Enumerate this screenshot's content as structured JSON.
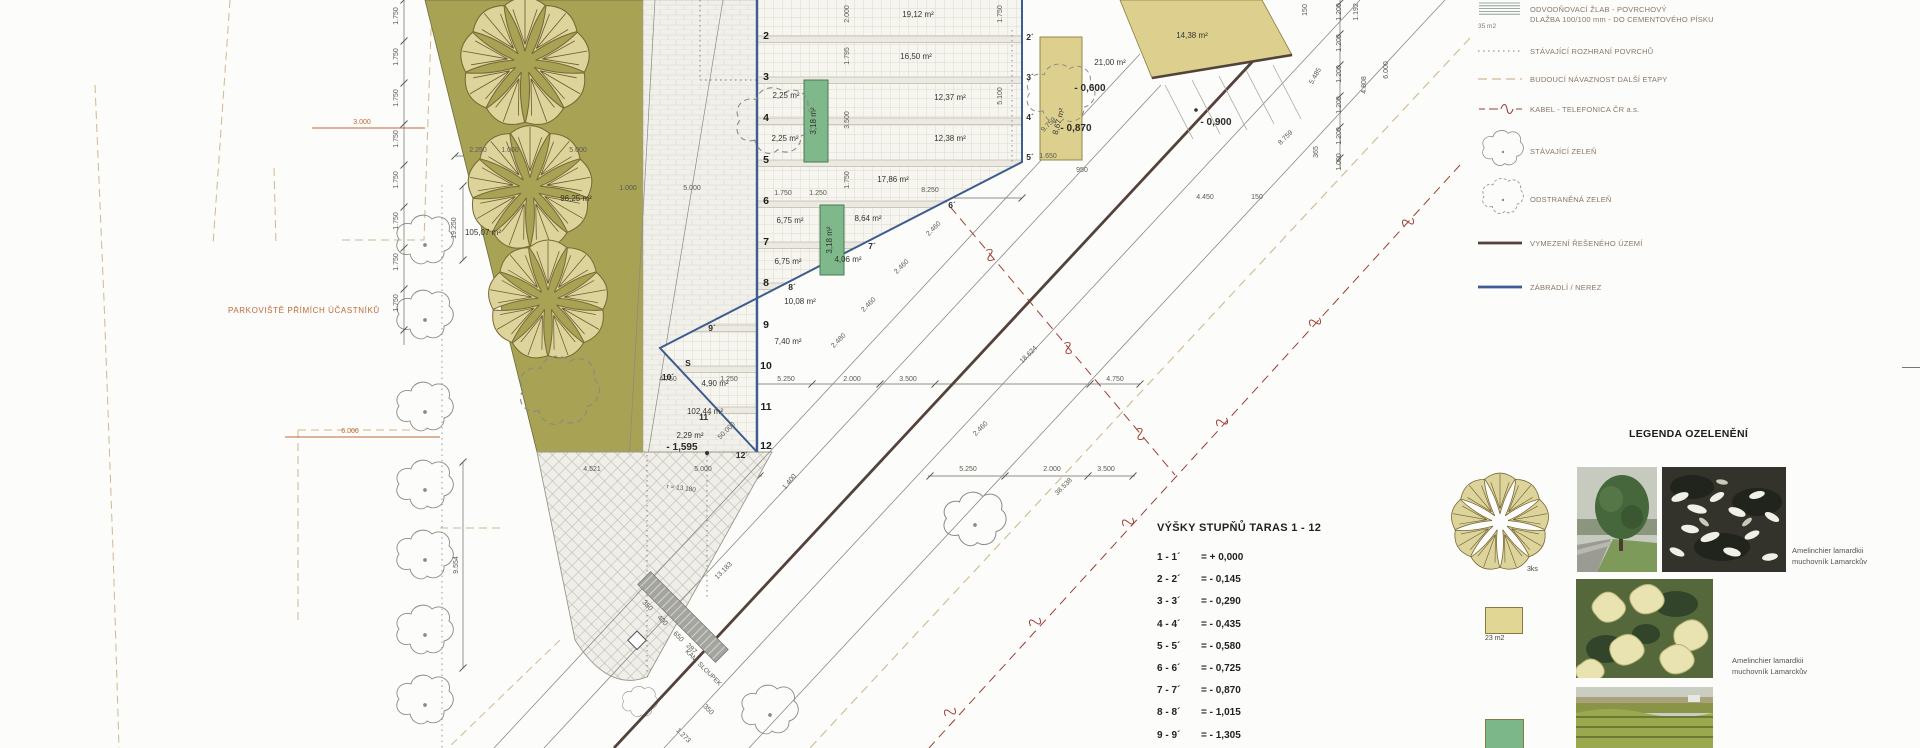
{
  "colors": {
    "olive": "#a7a254",
    "tan": "#ddd08f",
    "green_rect": "#7eb88b",
    "blue": "#3d5c8f",
    "kabel_red": "#9e3d33",
    "orange": "#c06a38",
    "dark_boundary": "#52423a"
  },
  "plan": {
    "parking_label": "PARKOVIŠTĚ PŘÍMÍCH ÚČASTNÍKŮ",
    "dim_labels": [
      {
        "t": "19.250",
        "x": 456,
        "y": 228,
        "r": -90
      },
      {
        "t": "9.554",
        "x": 458,
        "y": 565,
        "r": -90
      },
      {
        "t": "3.000",
        "x": 362,
        "y": 124,
        "c": "orange"
      },
      {
        "t": "6.000",
        "x": 350,
        "y": 433,
        "c": "orange"
      },
      {
        "t": "1.750",
        "x": 398,
        "y": 16,
        "r": -90
      },
      {
        "t": "1.750",
        "x": 398,
        "y": 57,
        "r": -90
      },
      {
        "t": "1.750",
        "x": 398,
        "y": 98,
        "r": -90
      },
      {
        "t": "1.750",
        "x": 398,
        "y": 139,
        "r": -90
      },
      {
        "t": "1.750",
        "x": 398,
        "y": 180,
        "r": -90
      },
      {
        "t": "1.750",
        "x": 398,
        "y": 221,
        "r": -90
      },
      {
        "t": "1.750",
        "x": 398,
        "y": 262,
        "r": -90
      },
      {
        "t": "1.750",
        "x": 398,
        "y": 303,
        "r": -90
      },
      {
        "t": "2.250",
        "x": 478,
        "y": 152
      },
      {
        "t": "1.000",
        "x": 510,
        "y": 152
      },
      {
        "t": "5.000",
        "x": 578,
        "y": 152
      },
      {
        "t": "1.000",
        "x": 628,
        "y": 190
      },
      {
        "t": "5.000",
        "x": 692,
        "y": 190
      },
      {
        "t": "2.000",
        "x": 849,
        "y": 14,
        "r": -90
      },
      {
        "t": "1.795",
        "x": 849,
        "y": 56,
        "r": -90
      },
      {
        "t": "3.500",
        "x": 849,
        "y": 120,
        "r": -90
      },
      {
        "t": "1.750",
        "x": 849,
        "y": 180,
        "r": -90
      },
      {
        "t": "1.750",
        "x": 783,
        "y": 195
      },
      {
        "t": "1.250",
        "x": 818,
        "y": 195
      },
      {
        "t": "8.250",
        "x": 930,
        "y": 192
      },
      {
        "t": "1.650",
        "x": 1048,
        "y": 158
      },
      {
        "t": "950",
        "x": 1082,
        "y": 172
      },
      {
        "t": "4.450",
        "x": 1205,
        "y": 199
      },
      {
        "t": "150",
        "x": 1257,
        "y": 199
      },
      {
        "t": "1.750",
        "x": 1002,
        "y": 14,
        "r": -90
      },
      {
        "t": "5.100",
        "x": 1002,
        "y": 96,
        "r": -90
      },
      {
        "t": "150",
        "x": 1307,
        "y": 10,
        "r": -90
      },
      {
        "t": "1.200",
        "x": 1341,
        "y": 12,
        "r": -90
      },
      {
        "t": "1.200",
        "x": 1341,
        "y": 43,
        "r": -90
      },
      {
        "t": "1.200",
        "x": 1341,
        "y": 74,
        "r": -90
      },
      {
        "t": "1.200",
        "x": 1341,
        "y": 105,
        "r": -90
      },
      {
        "t": "1.200",
        "x": 1341,
        "y": 136,
        "r": -90
      },
      {
        "t": "1.000",
        "x": 1341,
        "y": 162,
        "r": -90
      },
      {
        "t": "365",
        "x": 1318,
        "y": 152,
        "r": -90
      },
      {
        "t": "1.192",
        "x": 1358,
        "y": 12,
        "r": -90
      },
      {
        "t": "4.808",
        "x": 1366,
        "y": 85,
        "r": -90
      },
      {
        "t": "6.000",
        "x": 1388,
        "y": 70,
        "r": -90
      },
      {
        "t": "5.485",
        "x": 1317,
        "y": 77,
        "r": -60
      },
      {
        "t": "8.759",
        "x": 1287,
        "y": 139,
        "r": -45
      },
      {
        "t": "9.759",
        "x": 1050,
        "y": 126,
        "r": -45
      },
      {
        "t": "4.750",
        "x": 668,
        "y": 381
      },
      {
        "t": "1.250",
        "x": 729,
        "y": 381
      },
      {
        "t": "5.250",
        "x": 786,
        "y": 381
      },
      {
        "t": "2.000",
        "x": 852,
        "y": 381
      },
      {
        "t": "3.500",
        "x": 908,
        "y": 381
      },
      {
        "t": "4.750",
        "x": 1115,
        "y": 381
      },
      {
        "t": "4.521",
        "x": 592,
        "y": 471
      },
      {
        "t": "5.000",
        "x": 703,
        "y": 471
      },
      {
        "t": "5.250",
        "x": 968,
        "y": 471
      },
      {
        "t": "2.000",
        "x": 1052,
        "y": 471
      },
      {
        "t": "3.500",
        "x": 1106,
        "y": 471
      },
      {
        "t": "2.460",
        "x": 935,
        "y": 230,
        "r": -45
      },
      {
        "t": "2.460",
        "x": 903,
        "y": 268,
        "r": -45
      },
      {
        "t": "2.460",
        "x": 870,
        "y": 306,
        "r": -45
      },
      {
        "t": "2.480",
        "x": 840,
        "y": 342,
        "r": -45
      },
      {
        "t": "2.460",
        "x": 982,
        "y": 430,
        "r": -45
      },
      {
        "t": "18.624",
        "x": 1030,
        "y": 356,
        "r": -45
      },
      {
        "t": "38.538",
        "x": 1065,
        "y": 488,
        "r": -45
      },
      {
        "t": "50.000",
        "x": 728,
        "y": 432,
        "r": -45
      },
      {
        "t": "13.183",
        "x": 725,
        "y": 572,
        "r": -45
      },
      {
        "t": "1.400",
        "x": 791,
        "y": 483,
        "r": -50
      },
      {
        "t": "350",
        "x": 646,
        "y": 607,
        "r": 45
      },
      {
        "t": "400",
        "x": 661,
        "y": 622,
        "r": 45
      },
      {
        "t": "650",
        "x": 677,
        "y": 638,
        "r": 45
      },
      {
        "t": "287",
        "x": 690,
        "y": 650,
        "r": 45
      },
      {
        "t": "350",
        "x": 707,
        "y": 711,
        "r": 45
      },
      {
        "t": "1.273",
        "x": 682,
        "y": 737,
        "r": 45
      }
    ],
    "area_labels": [
      {
        "t": "96,25 m²",
        "x": 576,
        "y": 201
      },
      {
        "t": "105,07 m²",
        "x": 483,
        "y": 235
      },
      {
        "t": "19,12 m²",
        "x": 918,
        "y": 17
      },
      {
        "t": "16,50 m²",
        "x": 916,
        "y": 59
      },
      {
        "t": "12,37 m²",
        "x": 950,
        "y": 100
      },
      {
        "t": "12,38 m²",
        "x": 950,
        "y": 141
      },
      {
        "t": "2,25 m²",
        "x": 786,
        "y": 98
      },
      {
        "t": "2,25 m²",
        "x": 785,
        "y": 141
      },
      {
        "t": "17,86 m²",
        "x": 893,
        "y": 182
      },
      {
        "t": "6,75 m²",
        "x": 790,
        "y": 223
      },
      {
        "t": "8,64 m²",
        "x": 868,
        "y": 221
      },
      {
        "t": "6,75 m²",
        "x": 788,
        "y": 264
      },
      {
        "t": "4,06 m²",
        "x": 848,
        "y": 262
      },
      {
        "t": "10,08 m²",
        "x": 800,
        "y": 304
      },
      {
        "t": "7,40 m²",
        "x": 788,
        "y": 344
      },
      {
        "t": "4,90 m²",
        "x": 715,
        "y": 386
      },
      {
        "t": "102,44 m²",
        "x": 705,
        "y": 414
      },
      {
        "t": "2,29 m²",
        "x": 690,
        "y": 438
      },
      {
        "t": "21,00 m²",
        "x": 1110,
        "y": 65
      },
      {
        "t": "14,38 m²",
        "x": 1192,
        "y": 38
      },
      {
        "t": "3,18 m²",
        "x": 816,
        "y": 121,
        "r": -90
      },
      {
        "t": "3,18 m²",
        "x": 832,
        "y": 240,
        "r": -90
      },
      {
        "t": "8,67 m²",
        "x": 1061,
        "y": 122,
        "r": -75
      }
    ],
    "level_labels": [
      {
        "t": "- 1,595",
        "x": 682,
        "y": 450,
        "s": 10.5
      },
      {
        "t": "- 0,600",
        "x": 1090,
        "y": 91,
        "s": 10
      },
      {
        "t": "- 0,870",
        "x": 1076,
        "y": 131,
        "s": 10
      },
      {
        "t": "- 0,900",
        "x": 1216,
        "y": 125,
        "s": 12.5
      }
    ],
    "terrace_numbers": [
      {
        "t": "2",
        "x": 766,
        "y": 39
      },
      {
        "t": "3",
        "x": 766,
        "y": 80
      },
      {
        "t": "4",
        "x": 766,
        "y": 121
      },
      {
        "t": "5",
        "x": 766,
        "y": 163
      },
      {
        "t": "6",
        "x": 766,
        "y": 204
      },
      {
        "t": "7",
        "x": 766,
        "y": 245
      },
      {
        "t": "8",
        "x": 766,
        "y": 286
      },
      {
        "t": "9",
        "x": 766,
        "y": 328
      },
      {
        "t": "10",
        "x": 766,
        "y": 369
      },
      {
        "t": "11",
        "x": 766,
        "y": 410
      },
      {
        "t": "12",
        "x": 766,
        "y": 449
      }
    ],
    "primed_numbers": [
      {
        "t": "2´",
        "x": 1030,
        "y": 40
      },
      {
        "t": "3´",
        "x": 1030,
        "y": 80
      },
      {
        "t": "4´",
        "x": 1030,
        "y": 120
      },
      {
        "t": "5´",
        "x": 1030,
        "y": 160
      },
      {
        "t": "6´",
        "x": 952,
        "y": 208
      },
      {
        "t": "7´",
        "x": 872,
        "y": 249
      },
      {
        "t": "8´",
        "x": 792,
        "y": 290
      },
      {
        "t": "9´",
        "x": 712,
        "y": 331
      },
      {
        "t": "10´",
        "x": 668,
        "y": 380
      },
      {
        "t": "11´",
        "x": 705,
        "y": 420
      },
      {
        "t": "12´",
        "x": 742,
        "y": 458
      },
      {
        "t": "S",
        "x": 688,
        "y": 366
      }
    ],
    "note_labels": [
      {
        "t": "r = 13.180",
        "x": 681,
        "y": 490,
        "r": 7
      },
      {
        "t": "KAM. SLOUPEK",
        "x": 702,
        "y": 669,
        "r": 45
      }
    ]
  },
  "heights_table": {
    "title": "VÝŠKY STUPŇŮ TARAS  1 - 12",
    "rows": [
      {
        "k": "1 - 1´",
        "v": "=  + 0,000"
      },
      {
        "k": "2 - 2´",
        "v": "=  - 0,145"
      },
      {
        "k": "3 - 3´",
        "v": "=  - 0,290"
      },
      {
        "k": "4 - 4´",
        "v": "=  - 0,435"
      },
      {
        "k": "5 - 5´",
        "v": "=  - 0,580"
      },
      {
        "k": "6 - 6´",
        "v": "=  - 0,725"
      },
      {
        "k": "7 - 7´",
        "v": "=  - 0,870"
      },
      {
        "k": "8 - 8´",
        "v": "=  - 1,015"
      },
      {
        "k": "9 - 9´",
        "v": "=  - 1,305"
      }
    ]
  },
  "legend": {
    "items": [
      {
        "symbol": "hatch",
        "note": "35 m2",
        "text": "ODVODŇOVACÍ ŽLAB - POVRCHOVÝ",
        "text2": "DLAŽBA 100/100 mm - DO CEMENTOVÉHO PÍSKU",
        "y": 0,
        "h": 30
      },
      {
        "symbol": "dotted",
        "text": "STÁVAJÍCÍ ROZHRANÍ POVRCHŮ",
        "y": 44,
        "h": 16
      },
      {
        "symbol": "dash-tan",
        "text": "BUDOUCÍ NÁVAZNOST DALŠÍ ETAPY",
        "y": 72,
        "h": 16
      },
      {
        "symbol": "kabel",
        "text": "KABEL - TELEFONICA ČR a.s.",
        "y": 102,
        "h": 16
      },
      {
        "symbol": "cloud",
        "text": "STÁVAJÍCÍ ZELEŇ",
        "y": 126,
        "h": 52
      },
      {
        "symbol": "cloud-dashed",
        "text": "ODSTRANĚNÁ ZELEŇ",
        "y": 174,
        "h": 52
      },
      {
        "symbol": "thick",
        "text": "VYMEZENÍ ŘEŠENÉHO ÚZEMÍ",
        "y": 236,
        "h": 16
      },
      {
        "symbol": "blue",
        "text": "ZÁBRADLÍ / NEREZ",
        "y": 280,
        "h": 16
      }
    ]
  },
  "greenery": {
    "title": "LEGENDA OZELENĚNÍ",
    "items": [
      {
        "qty": "3ks",
        "label": "Amelinchier lamardkii",
        "label2": "muchovník Lamarckův"
      },
      {
        "qty": "23 m2",
        "label": "Amelinchier lamardkii",
        "label2": "muchovník Lamarckův"
      },
      {
        "qty": "",
        "label": "",
        "label2": ""
      }
    ]
  }
}
